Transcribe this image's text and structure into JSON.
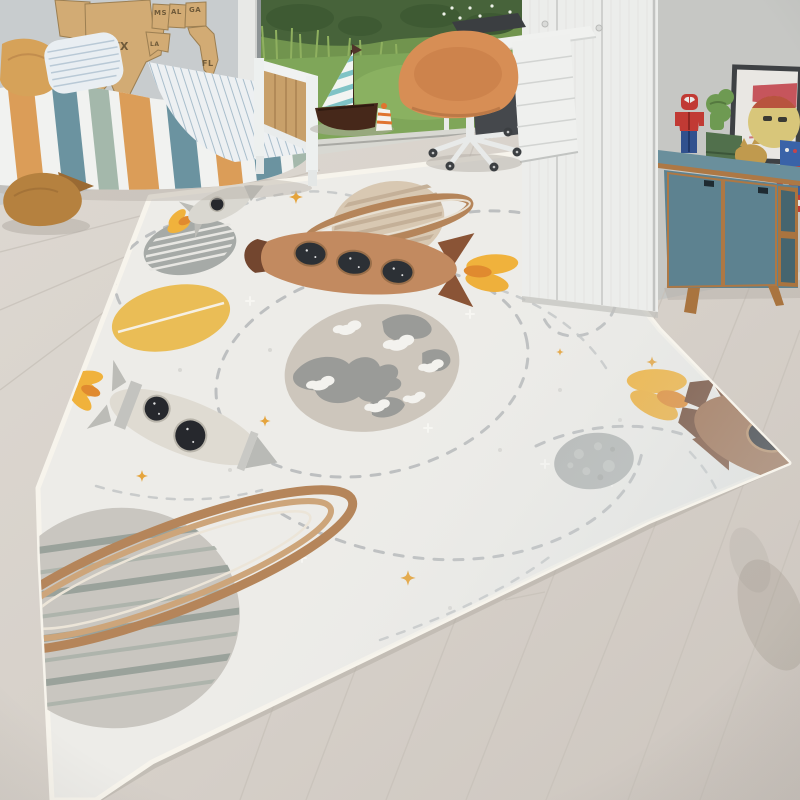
{
  "scene": {
    "caption": "Bright children's bedroom with a space-motif play rug on light wood flooring",
    "colors": {
      "wall": "#c8ccce",
      "right_wall": "#c6c7c4",
      "rug_base": "#edece8",
      "rug_binding": "#f7f4ec",
      "chair_orange": "#d78e55",
      "sideboard_teal": "#5d8290",
      "wood_trim": "#ad7845",
      "bed_teal": "#6b93a0",
      "bed_orange": "#db9d58",
      "bed_sage": "#a4b8ab",
      "rocket_tan": "#c28a60",
      "rocket_cream": "#dfdbd2",
      "rocket_brown": "#9c6b4a",
      "flame_yellow": "#f0b23c",
      "flame_orange": "#e08a2f",
      "star_orange": "#e5a43c",
      "path_gray": "#b7babb",
      "earth_base": "#cdc6bc",
      "earth_land": "#9a9b98",
      "moon_gray": "#b4b7b5",
      "saturn_sand": "#d8c8b2",
      "ring_brown": "#b5855a",
      "map_wood": "#d2ab74",
      "garden_green": "#71944e",
      "lawn_green": "#7fa659",
      "sail_teal": "#7fc3c6",
      "hull_brown": "#46281a",
      "plush_caramel": "#b5813f",
      "spiderman_red": "#c13a34",
      "lego_blue": "#31518e",
      "shield_red": "#bf3c37"
    }
  },
  "wall_map": {
    "material": "wood",
    "labels": [
      "AK",
      "TX",
      "LA",
      "MS",
      "AL",
      "GA",
      "FL"
    ]
  },
  "rug": {
    "motifs": [
      "rocket",
      "saturn",
      "striped-planet",
      "sun-planet",
      "earth",
      "moon",
      "ringed-planet",
      "dashed-orbit-paths",
      "sparkle-stars"
    ]
  },
  "furniture": [
    "bed",
    "wardrobe",
    "desk",
    "drawer-unit",
    "desk-chair",
    "sideboard"
  ],
  "toys": [
    "sailboat",
    "plush-toy",
    "spiderman-minifig",
    "picture-frame",
    "captain-shield",
    "yellow-head",
    "green-box"
  ]
}
